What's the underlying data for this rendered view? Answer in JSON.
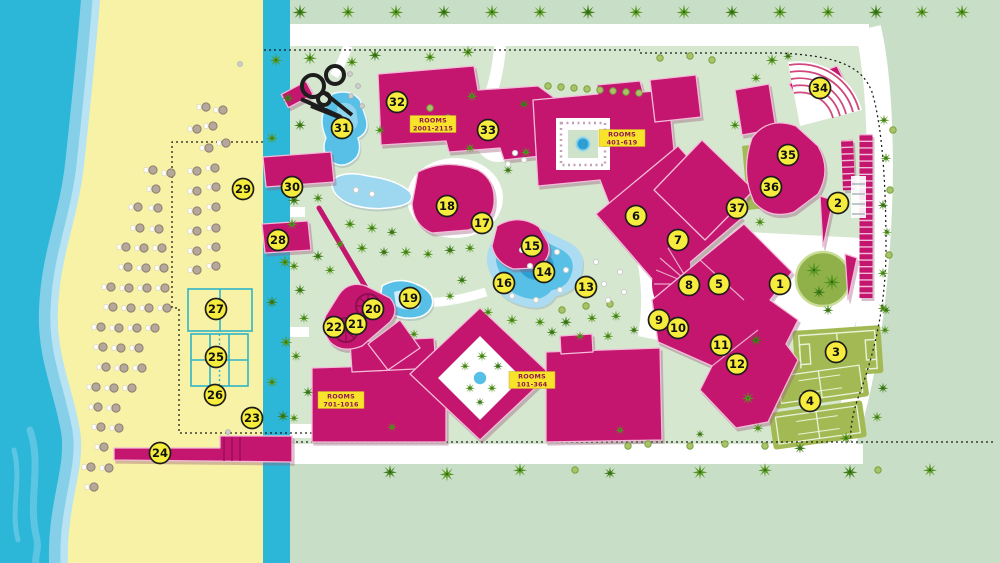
{
  "map": {
    "colors": {
      "ocean": "#2cb6d8",
      "sand": "#f8f2a6",
      "inner_green": "#d6e7d0",
      "outer_green": "#c8dec6",
      "building": "#c4156f",
      "building_outline": "#f2bcd8",
      "pool": "#58c0e6",
      "pool_deep": "#2d9fd2",
      "olive": "#a3ba54",
      "marker_fill": "#f6ec3d",
      "marker_border": "#1c1c1c",
      "label_bg": "#f6e32a",
      "label_text": "#8f1753",
      "palm": "#4a8a1c",
      "path": "#ffffff"
    },
    "rooms_labels": [
      {
        "name": "rooms-2001-2115",
        "line1": "ROOMS",
        "line2": "2001-2115"
      },
      {
        "name": "rooms-401-619",
        "line1": "ROOMS",
        "line2": "401-619"
      },
      {
        "name": "rooms-101-364",
        "line1": "ROOMS",
        "line2": "101-364"
      },
      {
        "name": "rooms-701-1016",
        "line1": "ROOMS",
        "line2": "701-1016"
      }
    ],
    "markers": [
      {
        "n": "1",
        "x": 780,
        "y": 284
      },
      {
        "n": "2",
        "x": 838,
        "y": 203
      },
      {
        "n": "3",
        "x": 836,
        "y": 352
      },
      {
        "n": "4",
        "x": 810,
        "y": 401
      },
      {
        "n": "5",
        "x": 719,
        "y": 284
      },
      {
        "n": "6",
        "x": 636,
        "y": 216
      },
      {
        "n": "7",
        "x": 678,
        "y": 240
      },
      {
        "n": "8",
        "x": 689,
        "y": 285
      },
      {
        "n": "9",
        "x": 659,
        "y": 320
      },
      {
        "n": "10",
        "x": 678,
        "y": 328
      },
      {
        "n": "11",
        "x": 721,
        "y": 345
      },
      {
        "n": "12",
        "x": 737,
        "y": 364
      },
      {
        "n": "13",
        "x": 586,
        "y": 287
      },
      {
        "n": "14",
        "x": 544,
        "y": 272
      },
      {
        "n": "15",
        "x": 532,
        "y": 246
      },
      {
        "n": "16",
        "x": 504,
        "y": 283
      },
      {
        "n": "17",
        "x": 482,
        "y": 223
      },
      {
        "n": "18",
        "x": 447,
        "y": 206
      },
      {
        "n": "19",
        "x": 410,
        "y": 298
      },
      {
        "n": "20",
        "x": 373,
        "y": 309
      },
      {
        "n": "21",
        "x": 356,
        "y": 324
      },
      {
        "n": "22",
        "x": 334,
        "y": 327
      },
      {
        "n": "23",
        "x": 252,
        "y": 418
      },
      {
        "n": "24",
        "x": 160,
        "y": 453
      },
      {
        "n": "25",
        "x": 216,
        "y": 357
      },
      {
        "n": "26",
        "x": 215,
        "y": 395
      },
      {
        "n": "27",
        "x": 216,
        "y": 309
      },
      {
        "n": "28",
        "x": 278,
        "y": 240
      },
      {
        "n": "29",
        "x": 243,
        "y": 189
      },
      {
        "n": "30",
        "x": 292,
        "y": 187
      },
      {
        "n": "31",
        "x": 342,
        "y": 128
      },
      {
        "n": "32",
        "x": 397,
        "y": 102
      },
      {
        "n": "33",
        "x": 488,
        "y": 130
      },
      {
        "n": "34",
        "x": 820,
        "y": 88
      },
      {
        "n": "35",
        "x": 788,
        "y": 155
      },
      {
        "n": "36",
        "x": 771,
        "y": 187
      },
      {
        "n": "37",
        "x": 737,
        "y": 208
      }
    ],
    "trees": [
      [
        300,
        12,
        0.75
      ],
      [
        348,
        12,
        0.7
      ],
      [
        396,
        12,
        0.75
      ],
      [
        444,
        12,
        0.7
      ],
      [
        492,
        12,
        0.75
      ],
      [
        540,
        12,
        0.7
      ],
      [
        588,
        12,
        0.75
      ],
      [
        636,
        12,
        0.7
      ],
      [
        684,
        12,
        0.75
      ],
      [
        732,
        12,
        0.7
      ],
      [
        780,
        12,
        0.75
      ],
      [
        828,
        12,
        0.7
      ],
      [
        876,
        12,
        0.75
      ],
      [
        922,
        12,
        0.7
      ],
      [
        962,
        12,
        0.75
      ],
      [
        390,
        472,
        0.7
      ],
      [
        447,
        474,
        0.75
      ],
      [
        520,
        470,
        0.7
      ],
      [
        610,
        473,
        0.6
      ],
      [
        700,
        472,
        0.75
      ],
      [
        765,
        470,
        0.7
      ],
      [
        850,
        472,
        0.75
      ],
      [
        930,
        470,
        0.7
      ],
      [
        276,
        60,
        0.65
      ],
      [
        288,
        98,
        0.6
      ],
      [
        272,
        138,
        0.6
      ],
      [
        285,
        262,
        0.65
      ],
      [
        272,
        302,
        0.6
      ],
      [
        286,
        342,
        0.65
      ],
      [
        272,
        382,
        0.6
      ],
      [
        283,
        416,
        0.6
      ],
      [
        884,
        120,
        0.55
      ],
      [
        886,
        158,
        0.55
      ],
      [
        883,
        205,
        0.55
      ],
      [
        887,
        232,
        0.5
      ],
      [
        883,
        273,
        0.55
      ],
      [
        886,
        310,
        0.5
      ],
      [
        310,
        58,
        0.7
      ],
      [
        352,
        62,
        0.6
      ],
      [
        375,
        55,
        0.65
      ],
      [
        430,
        57,
        0.6
      ],
      [
        468,
        52,
        0.65
      ],
      [
        300,
        125,
        0.6
      ],
      [
        380,
        130,
        0.55
      ],
      [
        340,
        135,
        0.5
      ],
      [
        294,
        200,
        0.65
      ],
      [
        318,
        198,
        0.55
      ],
      [
        292,
        224,
        0.6
      ],
      [
        318,
        256,
        0.6
      ],
      [
        294,
        266,
        0.55
      ],
      [
        330,
        270,
        0.55
      ],
      [
        300,
        290,
        0.6
      ],
      [
        350,
        224,
        0.6
      ],
      [
        372,
        228,
        0.6
      ],
      [
        392,
        232,
        0.55
      ],
      [
        340,
        244,
        0.5
      ],
      [
        362,
        248,
        0.6
      ],
      [
        384,
        252,
        0.55
      ],
      [
        406,
        252,
        0.6
      ],
      [
        428,
        254,
        0.55
      ],
      [
        450,
        250,
        0.6
      ],
      [
        470,
        248,
        0.55
      ],
      [
        472,
        96,
        0.6
      ],
      [
        524,
        104,
        0.55
      ],
      [
        470,
        148,
        0.55
      ],
      [
        526,
        152,
        0.55
      ],
      [
        508,
        170,
        0.5
      ],
      [
        512,
        320,
        0.6
      ],
      [
        540,
        322,
        0.55
      ],
      [
        566,
        322,
        0.6
      ],
      [
        592,
        318,
        0.55
      ],
      [
        488,
        312,
        0.55
      ],
      [
        462,
        280,
        0.55
      ],
      [
        450,
        296,
        0.5
      ],
      [
        616,
        316,
        0.55
      ],
      [
        552,
        332,
        0.55
      ],
      [
        580,
        336,
        0.5
      ],
      [
        608,
        336,
        0.55
      ],
      [
        634,
        330,
        0.5
      ],
      [
        772,
        60,
        0.65
      ],
      [
        756,
        78,
        0.55
      ],
      [
        788,
        56,
        0.5
      ],
      [
        735,
        125,
        0.55
      ],
      [
        760,
        222,
        0.55
      ],
      [
        756,
        340,
        0.65
      ],
      [
        748,
        398,
        0.65
      ],
      [
        758,
        428,
        0.55
      ],
      [
        800,
        448,
        0.6
      ],
      [
        846,
        438,
        0.65
      ],
      [
        877,
        417,
        0.55
      ],
      [
        883,
        388,
        0.55
      ],
      [
        885,
        330,
        0.5
      ],
      [
        883,
        308,
        0.55
      ],
      [
        828,
        310,
        0.55
      ],
      [
        392,
        427,
        0.5
      ],
      [
        620,
        430,
        0.5
      ],
      [
        700,
        434,
        0.45
      ],
      [
        465,
        366,
        0.5
      ],
      [
        482,
        356,
        0.55
      ],
      [
        498,
        366,
        0.5
      ],
      [
        470,
        388,
        0.5
      ],
      [
        492,
        388,
        0.5
      ],
      [
        480,
        402,
        0.45
      ],
      [
        814,
        270,
        0.8
      ],
      [
        832,
        282,
        0.85
      ],
      [
        819,
        292,
        0.65
      ],
      [
        304,
        318,
        0.55
      ],
      [
        296,
        356,
        0.55
      ],
      [
        308,
        392,
        0.55
      ],
      [
        294,
        418,
        0.5
      ],
      [
        414,
        334,
        0.5
      ]
    ],
    "bushes": [
      [
        548,
        86
      ],
      [
        561,
        87
      ],
      [
        574,
        88
      ],
      [
        587,
        89
      ],
      [
        600,
        90
      ],
      [
        613,
        91
      ],
      [
        626,
        92
      ],
      [
        639,
        93
      ],
      [
        660,
        58
      ],
      [
        690,
        56
      ],
      [
        712,
        60
      ],
      [
        430,
        108
      ],
      [
        448,
        118
      ],
      [
        586,
        306
      ],
      [
        610,
        304
      ],
      [
        562,
        310
      ],
      [
        628,
        446
      ],
      [
        648,
        444
      ],
      [
        690,
        446
      ],
      [
        725,
        444
      ],
      [
        765,
        446
      ],
      [
        575,
        470
      ],
      [
        878,
        470
      ],
      [
        893,
        130
      ],
      [
        890,
        190
      ],
      [
        889,
        255
      ]
    ],
    "loungers": [
      [
        522,
        250
      ],
      [
        540,
        248
      ],
      [
        557,
        252
      ],
      [
        530,
        266
      ],
      [
        548,
        266
      ],
      [
        566,
        270
      ],
      [
        588,
        278
      ],
      [
        604,
        284
      ],
      [
        560,
        290
      ],
      [
        585,
        296
      ],
      [
        608,
        300
      ],
      [
        624,
        292
      ],
      [
        536,
        300
      ],
      [
        512,
        296
      ],
      [
        596,
        262
      ],
      [
        620,
        272
      ],
      [
        356,
        190
      ],
      [
        372,
        194
      ],
      [
        515,
        153
      ],
      [
        524,
        160
      ],
      [
        508,
        164
      ]
    ],
    "stones": [
      [
        350,
        74
      ],
      [
        358,
        86
      ],
      [
        351,
        96
      ],
      [
        362,
        106
      ],
      [
        228,
        432
      ],
      [
        240,
        64
      ]
    ],
    "umbrellas": [
      [
        205,
        107
      ],
      [
        222,
        110
      ],
      [
        212,
        126
      ],
      [
        196,
        129
      ],
      [
        225,
        143
      ],
      [
        208,
        148
      ],
      [
        214,
        168
      ],
      [
        196,
        171
      ],
      [
        152,
        170
      ],
      [
        170,
        173
      ],
      [
        215,
        187
      ],
      [
        196,
        191
      ],
      [
        155,
        189
      ],
      [
        215,
        207
      ],
      [
        196,
        211
      ],
      [
        137,
        207
      ],
      [
        157,
        208
      ],
      [
        215,
        228
      ],
      [
        196,
        231
      ],
      [
        139,
        228
      ],
      [
        158,
        229
      ],
      [
        215,
        247
      ],
      [
        196,
        251
      ],
      [
        125,
        247
      ],
      [
        143,
        248
      ],
      [
        161,
        248
      ],
      [
        215,
        266
      ],
      [
        196,
        270
      ],
      [
        127,
        267
      ],
      [
        145,
        268
      ],
      [
        163,
        268
      ],
      [
        110,
        287
      ],
      [
        128,
        288
      ],
      [
        146,
        288
      ],
      [
        164,
        288
      ],
      [
        112,
        307
      ],
      [
        130,
        308
      ],
      [
        148,
        308
      ],
      [
        166,
        308
      ],
      [
        100,
        327
      ],
      [
        118,
        328
      ],
      [
        136,
        328
      ],
      [
        154,
        328
      ],
      [
        102,
        347
      ],
      [
        120,
        348
      ],
      [
        138,
        348
      ],
      [
        105,
        367
      ],
      [
        123,
        368
      ],
      [
        141,
        368
      ],
      [
        95,
        387
      ],
      [
        113,
        388
      ],
      [
        131,
        388
      ],
      [
        97,
        407
      ],
      [
        115,
        408
      ],
      [
        100,
        427
      ],
      [
        118,
        428
      ],
      [
        103,
        447
      ],
      [
        90,
        467
      ],
      [
        108,
        468
      ],
      [
        93,
        487
      ]
    ]
  }
}
